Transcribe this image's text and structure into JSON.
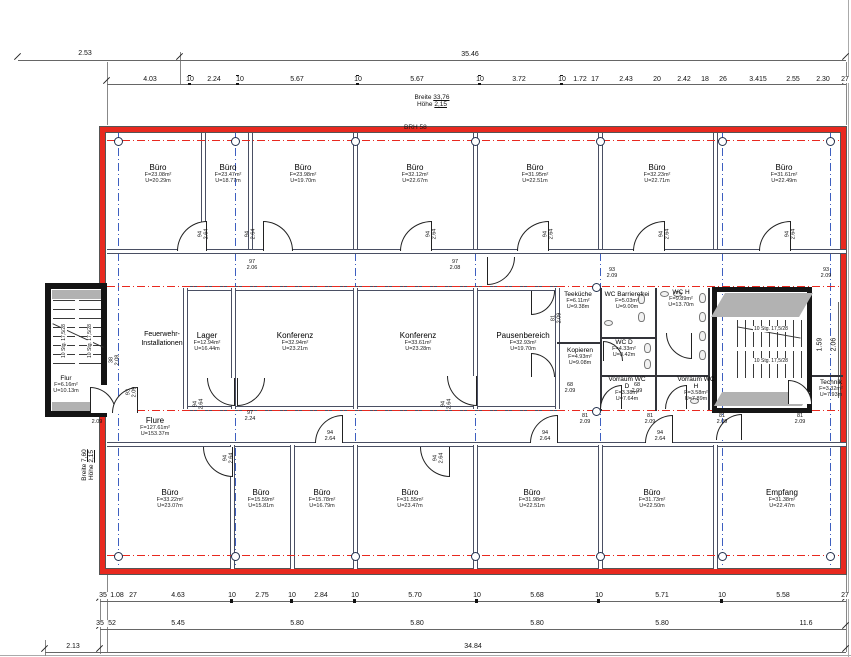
{
  "rooms": [
    {
      "name": "Büro",
      "area": "F=23.08m²",
      "perimeter": "U=20.29m"
    },
    {
      "name": "Büro",
      "area": "F=23.47m²",
      "perimeter": "U=18.77m"
    },
    {
      "name": "Büro",
      "area": "F=23.98m²",
      "perimeter": "U=19.70m"
    },
    {
      "name": "Büro",
      "area": "F=32.12m²",
      "perimeter": "U=22.67m"
    },
    {
      "name": "Büro",
      "area": "F=31.95m²",
      "perimeter": "U=22.51m"
    },
    {
      "name": "Büro",
      "area": "F=32.23m²",
      "perimeter": "U=22.71m"
    },
    {
      "name": "Büro",
      "area": "F=31.61m²",
      "perimeter": "U=22.49m"
    },
    {
      "name": "Feuerwehr-Installationen",
      "area": "",
      "perimeter": ""
    },
    {
      "name": "Lager",
      "area": "F=12.94m²",
      "perimeter": "U=16.44m"
    },
    {
      "name": "Konferenz",
      "area": "F=32.94m²",
      "perimeter": "U=23.21m"
    },
    {
      "name": "Konferenz",
      "area": "F=33.61m²",
      "perimeter": "U=23.28m"
    },
    {
      "name": "Pausenbereich",
      "area": "F=32.93m²",
      "perimeter": "U=19.70m"
    },
    {
      "name": "Teeküche",
      "area": "F=6.11m²",
      "perimeter": "U=9.38m"
    },
    {
      "name": "WC Barrierefrei",
      "area": "F=5.03m²",
      "perimeter": "U=9.00m"
    },
    {
      "name": "WC H",
      "area": "F=9.89m²",
      "perimeter": "U=13.70m"
    },
    {
      "name": "WC D",
      "area": "F=4.33m²",
      "perimeter": "U=8.42m"
    },
    {
      "name": "Kopieren",
      "area": "F=4.93m²",
      "perimeter": "U=9.08m"
    },
    {
      "name": "Vorraum WC D",
      "area": "F=3.38m²",
      "perimeter": "U=7.64m"
    },
    {
      "name": "Vorraum WC H",
      "area": "F=3.58m²",
      "perimeter": "U=7.89m"
    },
    {
      "name": "Technik",
      "area": "F=3.32m²",
      "perimeter": "U=7.93m"
    },
    {
      "name": "Flur",
      "area": "F=6.16m²",
      "perimeter": "U=10.13m"
    },
    {
      "name": "Flure",
      "area": "F=127.61m²",
      "perimeter": "U=153.37m"
    },
    {
      "name": "Büro",
      "area": "F=33.22m²",
      "perimeter": "U=23.07m"
    },
    {
      "name": "Büro",
      "area": "F=15.59m²",
      "perimeter": "U=15.81m"
    },
    {
      "name": "Büro",
      "area": "F=15.78m²",
      "perimeter": "U=16.79m"
    },
    {
      "name": "Büro",
      "area": "F=31.55m²",
      "perimeter": "U=23.47m"
    },
    {
      "name": "Büro",
      "area": "F=31.98m²",
      "perimeter": "U=22.51m"
    },
    {
      "name": "Büro",
      "area": "F=31.73m²",
      "perimeter": "U=22.50m"
    },
    {
      "name": "Empfang",
      "area": "F=31.38m²",
      "perimeter": "U=22.47m"
    }
  ],
  "annotations": {
    "breite_top_label": "Breite",
    "breite_top_value": "33,76",
    "hoehe_top_label": "Höhe",
    "hoehe_top_value": "2,15",
    "brh": "BRH 58",
    "breite_left_label": "Breite",
    "breite_left_value": "7,60",
    "hoehe_left_label": "Höhe",
    "hoehe_left_value": "2,15",
    "stair_run": "10 Stg. 17,5/28"
  },
  "dim_top": {
    "offset": "2.53",
    "total": "35.46",
    "segments": [
      "4.03",
      "10",
      "2.24",
      "10",
      "5.67",
      "10",
      "5.67",
      "10",
      "3.72",
      "10",
      "1.72",
      "17",
      "2.43",
      "20",
      "2.42",
      "18",
      "26",
      "3.415",
      "2.55",
      "2.30",
      "27"
    ]
  },
  "dim_bottom": {
    "row1": [
      "35",
      "1.08",
      "27",
      "4.63",
      "10",
      "2.75",
      "10",
      "2.84",
      "10",
      "5.70",
      "10",
      "5.68",
      "10",
      "5.71",
      "10",
      "5.58",
      "27"
    ],
    "row2": [
      "35",
      "52",
      "5.45",
      "5.80",
      "5.80",
      "5.80",
      "5.80",
      "11.6"
    ],
    "total": "34.84",
    "offset_left": "2.13"
  },
  "dim_right": {
    "v1": "1.59",
    "v2": "2.06"
  },
  "door_labels": [
    {
      "w": "94",
      "h": "2.64"
    },
    {
      "w": "94",
      "h": "2.64"
    },
    {
      "w": "94",
      "h": "2.64"
    },
    {
      "w": "94",
      "h": "2.64"
    },
    {
      "w": "94",
      "h": "2.64"
    },
    {
      "w": "94",
      "h": "2.64"
    },
    {
      "w": "97",
      "h": "2.06"
    },
    {
      "w": "97",
      "h": "2.08"
    },
    {
      "w": "93",
      "h": "2.09"
    },
    {
      "w": "93",
      "h": "2.09"
    },
    {
      "w": "94",
      "h": "2.64"
    },
    {
      "w": "97",
      "h": "2.24"
    },
    {
      "w": "94",
      "h": "2.64"
    },
    {
      "w": "68",
      "h": "2.09"
    },
    {
      "w": "68",
      "h": "2.09"
    },
    {
      "w": "81",
      "h": "2.09"
    },
    {
      "w": "81",
      "h": "2.09"
    },
    {
      "w": "81",
      "h": "2.09"
    },
    {
      "w": "81",
      "h": "2.09"
    },
    {
      "w": "81",
      "h": "2.09"
    },
    {
      "w": "38",
      "h": "2.08"
    },
    {
      "w": "93",
      "h": "2.09"
    },
    {
      "w": "94",
      "h": "2.64"
    },
    {
      "w": "94",
      "h": "2.64"
    },
    {
      "w": "94",
      "h": "2.64"
    },
    {
      "w": "94",
      "h": "2.64"
    },
    {
      "w": "94",
      "h": "2.64"
    },
    {
      "w": "81",
      "h": "2.09"
    }
  ]
}
